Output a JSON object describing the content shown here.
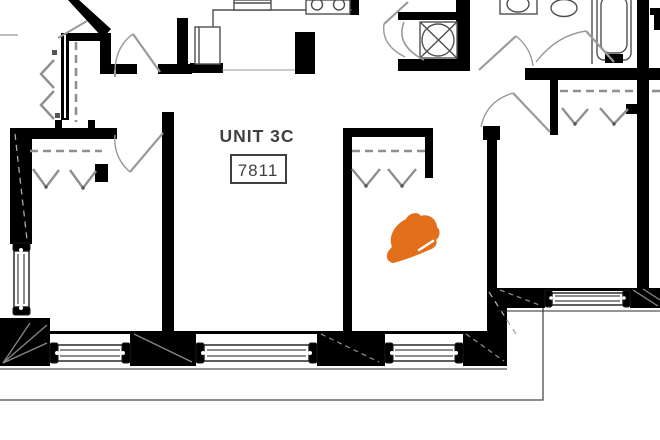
{
  "unit": {
    "name_label": "UNIT 3C",
    "number": "7811"
  },
  "marker": {
    "icon": "hard-hat-icon",
    "color": "#e2701b"
  },
  "colors": {
    "walls": "#000000",
    "door_lines": "#9a9a9a",
    "closet_lines": "#8f8f8f",
    "fixture_lines": "#4f4f4f",
    "label_text": "#3f3f3f",
    "background": "#ffffff"
  }
}
